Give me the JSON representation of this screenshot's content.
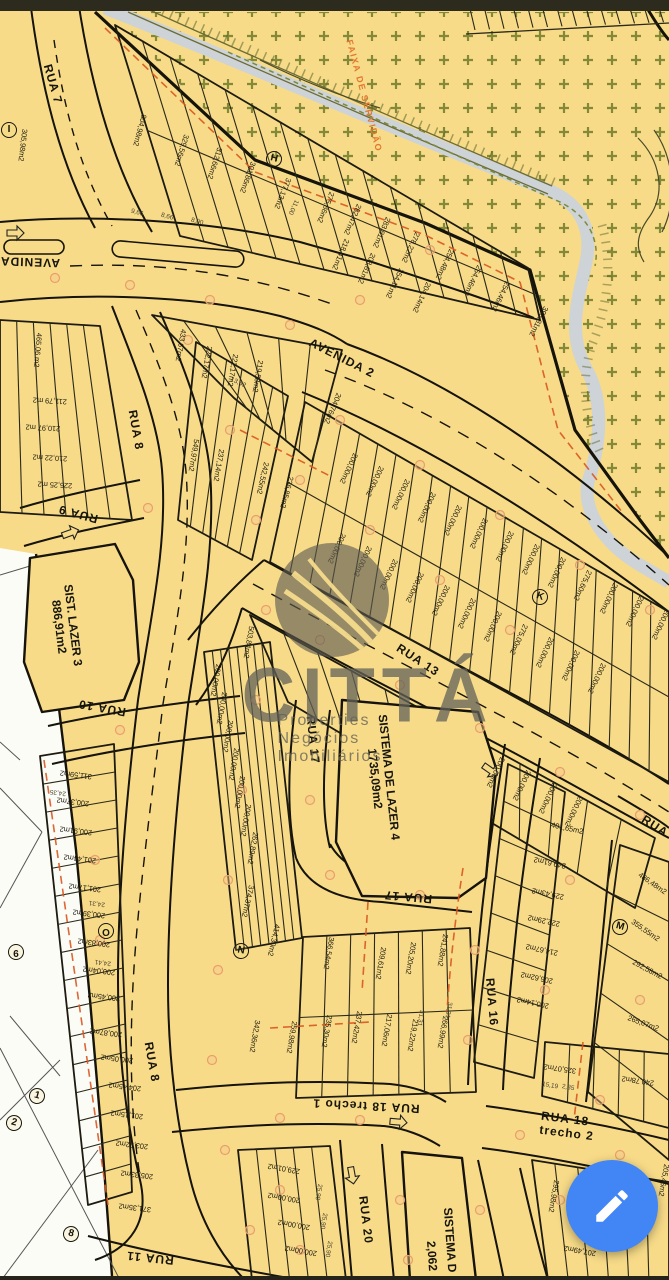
{
  "theme": {
    "map_bg": "#f7db88",
    "road_line": "#15130a",
    "fab_blue": "#4285f4",
    "red_dash": "#d9571f",
    "green_mark": "#77812e",
    "stream": "#cdd3d6",
    "watermark_gray": "#636158"
  },
  "watermark": {
    "brand": "CITTÁ",
    "tagline": "Properties Negócios Imobiliários"
  },
  "fab": {
    "action": "edit",
    "icon": "pencil-icon"
  },
  "map": {
    "labels": {
      "street": [
        {
          "t": "R​UA 7",
          "x": 53,
          "y": 84,
          "r": 74
        },
        {
          "t": "AVENIDA",
          "x": 30,
          "y": 262,
          "r": 182
        },
        {
          "t": "AVENIDA 2",
          "x": 342,
          "y": 358,
          "r": 27
        },
        {
          "t": "RUA 8",
          "x": 136,
          "y": 430,
          "r": 80
        },
        {
          "t": "RUA 9",
          "x": 78,
          "y": 514,
          "r": 195
        },
        {
          "t": "RUA 10",
          "x": 102,
          "y": 708,
          "r": 190
        },
        {
          "t": "RUA 13",
          "x": 418,
          "y": 660,
          "r": 33
        },
        {
          "t": "RUA 17",
          "x": 313,
          "y": 740,
          "r": 84
        },
        {
          "t": "RUA 17",
          "x": 408,
          "y": 897,
          "r": 185
        },
        {
          "t": "RUA 16",
          "x": 492,
          "y": 1002,
          "r": 85
        },
        {
          "t": "RUA 8",
          "x": 152,
          "y": 1062,
          "r": 80
        },
        {
          "t": "RUA 18 trecho 1",
          "x": 366,
          "y": 1106,
          "r": 183
        },
        {
          "t": "RUA 18 trecho 2",
          "x": 583,
          "y": 1128,
          "r": 7
        },
        {
          "t": "RUA 20",
          "x": 366,
          "y": 1220,
          "r": 83
        },
        {
          "t": "RUA 11",
          "x": 150,
          "y": 1258,
          "r": 186
        },
        {
          "t": "RUA",
          "x": 655,
          "y": 826,
          "r": 33
        }
      ],
      "area": [
        {
          "t": "SIST. LAZER 3\n886,91m2",
          "x": 66,
          "y": 626,
          "r": 83
        },
        {
          "t": "SISTEMA DE LAZER 4\n1735,09m2",
          "x": 382,
          "y": 778,
          "r": 84
        },
        {
          "t": "SISTEMA D",
          "x": 450,
          "y": 1240,
          "r": 86
        },
        {
          "t": "2,062",
          "x": 432,
          "y": 1256,
          "r": 86
        }
      ],
      "easement": [
        {
          "t": "FAIXA DE SERVIDÃO",
          "x": 364,
          "y": 96,
          "r": 75
        }
      ],
      "marker": [
        {
          "t": "I",
          "x": 9,
          "y": 130,
          "r": 0
        },
        {
          "t": "H",
          "x": 274,
          "y": 159,
          "r": 15
        },
        {
          "t": "K",
          "x": 540,
          "y": 597,
          "r": 20
        },
        {
          "t": "M",
          "x": 620,
          "y": 927,
          "r": 15
        },
        {
          "t": "N",
          "x": 241,
          "y": 951,
          "r": 10
        },
        {
          "t": "O",
          "x": 106,
          "y": 931,
          "r": 180
        },
        {
          "t": "9",
          "x": 16,
          "y": 952,
          "r": 180
        },
        {
          "t": "1",
          "x": 37,
          "y": 1096,
          "r": 15
        },
        {
          "t": "2",
          "x": 14,
          "y": 1123,
          "r": 15
        },
        {
          "t": "8",
          "x": 71,
          "y": 1234,
          "r": 15
        }
      ],
      "dim": [
        {
          "t": "25,90",
          "x": 318,
          "y": 1192,
          "r": 100
        },
        {
          "t": "25,90",
          "x": 323,
          "y": 1221,
          "r": 100
        },
        {
          "t": "25,90",
          "x": 328,
          "y": 1249,
          "r": 100
        },
        {
          "t": "24,35",
          "x": 58,
          "y": 792,
          "r": 187
        },
        {
          "t": "24,31",
          "x": 97,
          "y": 903,
          "r": 187
        },
        {
          "t": "24,41",
          "x": 103,
          "y": 962,
          "r": 187
        },
        {
          "t": "15,19",
          "x": 550,
          "y": 1086,
          "r": 10
        },
        {
          "t": "2,35",
          "x": 568,
          "y": 1088,
          "r": 10
        },
        {
          "t": "13,42",
          "x": 238,
          "y": 383,
          "r": 25
        },
        {
          "t": "11,00",
          "x": 293,
          "y": 207,
          "r": 115
        },
        {
          "t": "9,66",
          "x": 137,
          "y": 213,
          "r": 15
        },
        {
          "t": "8,66",
          "x": 167,
          "y": 217,
          "r": 15
        },
        {
          "t": "8,00",
          "x": 197,
          "y": 222,
          "r": 15
        },
        {
          "t": "31,31",
          "x": 448,
          "y": 1010,
          "r": 100
        },
        {
          "t": "31,31",
          "x": 420,
          "y": 1018,
          "r": 100
        }
      ],
      "lot": [
        {
          "t": "305,98m2",
          "x": 22,
          "y": 145,
          "r": 97
        },
        {
          "t": "804,98m2",
          "x": 139,
          "y": 130,
          "r": 105
        },
        {
          "t": "329,56m2",
          "x": 181,
          "y": 150,
          "r": 107
        },
        {
          "t": "312,66m2",
          "x": 214,
          "y": 163,
          "r": 108
        },
        {
          "t": "301,86m2",
          "x": 247,
          "y": 177,
          "r": 110
        },
        {
          "t": "377,13m2",
          "x": 282,
          "y": 193,
          "r": 112
        },
        {
          "t": "275,86m2",
          "x": 325,
          "y": 207,
          "r": 113
        },
        {
          "t": "282,47m2",
          "x": 352,
          "y": 219,
          "r": 114
        },
        {
          "t": "283,81m2",
          "x": 381,
          "y": 232,
          "r": 114
        },
        {
          "t": "278,22m2",
          "x": 410,
          "y": 247,
          "r": 115
        },
        {
          "t": "254,48m2",
          "x": 444,
          "y": 264,
          "r": 115
        },
        {
          "t": "254,46m2",
          "x": 472,
          "y": 280,
          "r": 115
        },
        {
          "t": "254,46m2",
          "x": 500,
          "y": 296,
          "r": 116
        },
        {
          "t": "393,81m2",
          "x": 538,
          "y": 321,
          "r": 117
        },
        {
          "t": "218,41m2",
          "x": 340,
          "y": 254,
          "r": 113
        },
        {
          "t": "208,81m2",
          "x": 366,
          "y": 268,
          "r": 114
        },
        {
          "t": "254,11m2",
          "x": 394,
          "y": 283,
          "r": 115
        },
        {
          "t": "204,14m2",
          "x": 421,
          "y": 297,
          "r": 115
        },
        {
          "t": "465,06 m2",
          "x": 37,
          "y": 350,
          "r": 95
        },
        {
          "t": "211,79 m2",
          "x": 50,
          "y": 400,
          "r": 183
        },
        {
          "t": "210,97 m2",
          "x": 43,
          "y": 427,
          "r": 183
        },
        {
          "t": "210,22 m2",
          "x": 50,
          "y": 457,
          "r": 183
        },
        {
          "t": "226,25 m2",
          "x": 55,
          "y": 484,
          "r": 183
        },
        {
          "t": "433,67m2",
          "x": 180,
          "y": 345,
          "r": 100
        },
        {
          "t": "222,17m2",
          "x": 206,
          "y": 362,
          "r": 100
        },
        {
          "t": "222,17m2",
          "x": 232,
          "y": 370,
          "r": 100
        },
        {
          "t": "219,58m2",
          "x": 257,
          "y": 376,
          "r": 100
        },
        {
          "t": "204,76m2",
          "x": 332,
          "y": 408,
          "r": 113
        },
        {
          "t": "549,97m2",
          "x": 193,
          "y": 455,
          "r": 100
        },
        {
          "t": "237,14m2",
          "x": 218,
          "y": 465,
          "r": 100
        },
        {
          "t": "242,55m2",
          "x": 262,
          "y": 478,
          "r": 103
        },
        {
          "t": "236,85m2",
          "x": 286,
          "y": 492,
          "r": 105
        },
        {
          "t": "200,00m2",
          "x": 348,
          "y": 468,
          "r": 115
        },
        {
          "t": "200,00m2",
          "x": 374,
          "y": 481,
          "r": 115
        },
        {
          "t": "200,00m2",
          "x": 400,
          "y": 494,
          "r": 115
        },
        {
          "t": "200,00m2",
          "x": 426,
          "y": 507,
          "r": 115
        },
        {
          "t": "200,00m2",
          "x": 452,
          "y": 520,
          "r": 115
        },
        {
          "t": "200,00m2",
          "x": 478,
          "y": 533,
          "r": 115
        },
        {
          "t": "200,00m2",
          "x": 504,
          "y": 546,
          "r": 115
        },
        {
          "t": "200,00m2",
          "x": 530,
          "y": 559,
          "r": 115
        },
        {
          "t": "200,00m2",
          "x": 556,
          "y": 572,
          "r": 115
        },
        {
          "t": "275,60m2",
          "x": 582,
          "y": 585,
          "r": 115
        },
        {
          "t": "200,00m2",
          "x": 608,
          "y": 598,
          "r": 115
        },
        {
          "t": "200,00m2",
          "x": 634,
          "y": 611,
          "r": 115
        },
        {
          "t": "200,00m2",
          "x": 660,
          "y": 624,
          "r": 115
        },
        {
          "t": "200,00m2",
          "x": 336,
          "y": 548,
          "r": 115
        },
        {
          "t": "200,00m2",
          "x": 362,
          "y": 561,
          "r": 115
        },
        {
          "t": "200,00m2",
          "x": 388,
          "y": 574,
          "r": 115
        },
        {
          "t": "200,00m2",
          "x": 414,
          "y": 587,
          "r": 115
        },
        {
          "t": "200,00m2",
          "x": 440,
          "y": 600,
          "r": 115
        },
        {
          "t": "200,00m2",
          "x": 466,
          "y": 613,
          "r": 115
        },
        {
          "t": "200,00m2",
          "x": 492,
          "y": 626,
          "r": 115
        },
        {
          "t": "275,00m2",
          "x": 518,
          "y": 639,
          "r": 115
        },
        {
          "t": "200,00m2",
          "x": 544,
          "y": 652,
          "r": 115
        },
        {
          "t": "200,00m2",
          "x": 570,
          "y": 665,
          "r": 115
        },
        {
          "t": "200,00m2",
          "x": 596,
          "y": 678,
          "r": 115
        },
        {
          "t": "200,00m2",
          "x": 495,
          "y": 772,
          "r": 115
        },
        {
          "t": "200,00m2",
          "x": 521,
          "y": 785,
          "r": 115
        },
        {
          "t": "200,00m2",
          "x": 547,
          "y": 798,
          "r": 115
        },
        {
          "t": "200,00m2",
          "x": 573,
          "y": 811,
          "r": 115
        },
        {
          "t": "401,65m2",
          "x": 567,
          "y": 829,
          "r": 12
        },
        {
          "t": "249,61m2",
          "x": 550,
          "y": 862,
          "r": 192
        },
        {
          "t": "229,43m2",
          "x": 548,
          "y": 893,
          "r": 192
        },
        {
          "t": "222,29m2",
          "x": 544,
          "y": 920,
          "r": 192
        },
        {
          "t": "214,67m2",
          "x": 542,
          "y": 949,
          "r": 192
        },
        {
          "t": "206,62m2",
          "x": 537,
          "y": 977,
          "r": 192
        },
        {
          "t": "200,14m2",
          "x": 533,
          "y": 1002,
          "r": 192
        },
        {
          "t": "486,48m2",
          "x": 652,
          "y": 884,
          "r": 35
        },
        {
          "t": "355,55m2",
          "x": 645,
          "y": 931,
          "r": 35
        },
        {
          "t": "292,58m2",
          "x": 647,
          "y": 970,
          "r": 28
        },
        {
          "t": "265,07m2",
          "x": 643,
          "y": 1024,
          "r": 20
        },
        {
          "t": "325,07m2",
          "x": 560,
          "y": 1068,
          "r": 188
        },
        {
          "t": "240,78m2",
          "x": 638,
          "y": 1080,
          "r": 188
        },
        {
          "t": "366,54m2",
          "x": 328,
          "y": 953,
          "r": 100
        },
        {
          "t": "209,61m2",
          "x": 380,
          "y": 963,
          "r": 100
        },
        {
          "t": "205,20m2",
          "x": 410,
          "y": 958,
          "r": 100
        },
        {
          "t": "241,88m2",
          "x": 442,
          "y": 950,
          "r": 100
        },
        {
          "t": "342,36m2",
          "x": 254,
          "y": 1036,
          "r": 100
        },
        {
          "t": "259,98m2",
          "x": 291,
          "y": 1037,
          "r": 100
        },
        {
          "t": "235,30m2",
          "x": 326,
          "y": 1031,
          "r": 100
        },
        {
          "t": "237,42m2",
          "x": 356,
          "y": 1027,
          "r": 100
        },
        {
          "t": "217,06m2",
          "x": 386,
          "y": 1030,
          "r": 100
        },
        {
          "t": "219,22m2",
          "x": 412,
          "y": 1035,
          "r": 100
        },
        {
          "t": "266,99m2",
          "x": 442,
          "y": 1032,
          "r": 100
        },
        {
          "t": "503,84m2",
          "x": 248,
          "y": 642,
          "r": 100
        },
        {
          "t": "200,00m2",
          "x": 215,
          "y": 680,
          "r": 100
        },
        {
          "t": "200,00m2",
          "x": 221,
          "y": 708,
          "r": 100
        },
        {
          "t": "200,00m2",
          "x": 227,
          "y": 736,
          "r": 100
        },
        {
          "t": "200,00m2",
          "x": 233,
          "y": 764,
          "r": 100
        },
        {
          "t": "200,00m2",
          "x": 239,
          "y": 792,
          "r": 100
        },
        {
          "t": "200,00m2",
          "x": 245,
          "y": 820,
          "r": 100
        },
        {
          "t": "262,89m2",
          "x": 252,
          "y": 848,
          "r": 100
        },
        {
          "t": "374,37m2",
          "x": 247,
          "y": 901,
          "r": 103
        },
        {
          "t": "414,30m2",
          "x": 273,
          "y": 940,
          "r": 103
        },
        {
          "t": "311,59m2",
          "x": 76,
          "y": 774,
          "r": 187
        },
        {
          "t": "200,37m2",
          "x": 73,
          "y": 801,
          "r": 187
        },
        {
          "t": "200,91m2",
          "x": 76,
          "y": 830,
          "r": 187
        },
        {
          "t": "201,44m2",
          "x": 80,
          "y": 858,
          "r": 187
        },
        {
          "t": "201,17m2",
          "x": 85,
          "y": 887,
          "r": 187
        },
        {
          "t": "200,39m2",
          "x": 89,
          "y": 913,
          "r": 187
        },
        {
          "t": "200,83m2",
          "x": 94,
          "y": 942,
          "r": 187
        },
        {
          "t": "200,04m2",
          "x": 99,
          "y": 970,
          "r": 187
        },
        {
          "t": "200,45m2",
          "x": 104,
          "y": 996,
          "r": 187
        },
        {
          "t": "200,87m2",
          "x": 106,
          "y": 1032,
          "r": 187
        },
        {
          "t": "200,05m2",
          "x": 117,
          "y": 1058,
          "r": 187
        },
        {
          "t": "204,45m2",
          "x": 125,
          "y": 1086,
          "r": 187
        },
        {
          "t": "201,15m2",
          "x": 127,
          "y": 1114,
          "r": 187
        },
        {
          "t": "203,92m2",
          "x": 132,
          "y": 1144,
          "r": 187
        },
        {
          "t": "205,33m2",
          "x": 137,
          "y": 1174,
          "r": 187
        },
        {
          "t": "371,35m2",
          "x": 135,
          "y": 1207,
          "r": 187
        },
        {
          "t": "229,01m2",
          "x": 284,
          "y": 1168,
          "r": 190
        },
        {
          "t": "200,00m2",
          "x": 284,
          "y": 1197,
          "r": 190
        },
        {
          "t": "200,00m2",
          "x": 294,
          "y": 1224,
          "r": 190
        },
        {
          "t": "200,00m2",
          "x": 301,
          "y": 1250,
          "r": 190
        },
        {
          "t": "295,98m2",
          "x": 553,
          "y": 1196,
          "r": 100
        },
        {
          "t": "205,46m2",
          "x": 663,
          "y": 1180,
          "r": 100
        },
        {
          "t": "207,49m2",
          "x": 580,
          "y": 1250,
          "r": 190
        }
      ]
    }
  }
}
